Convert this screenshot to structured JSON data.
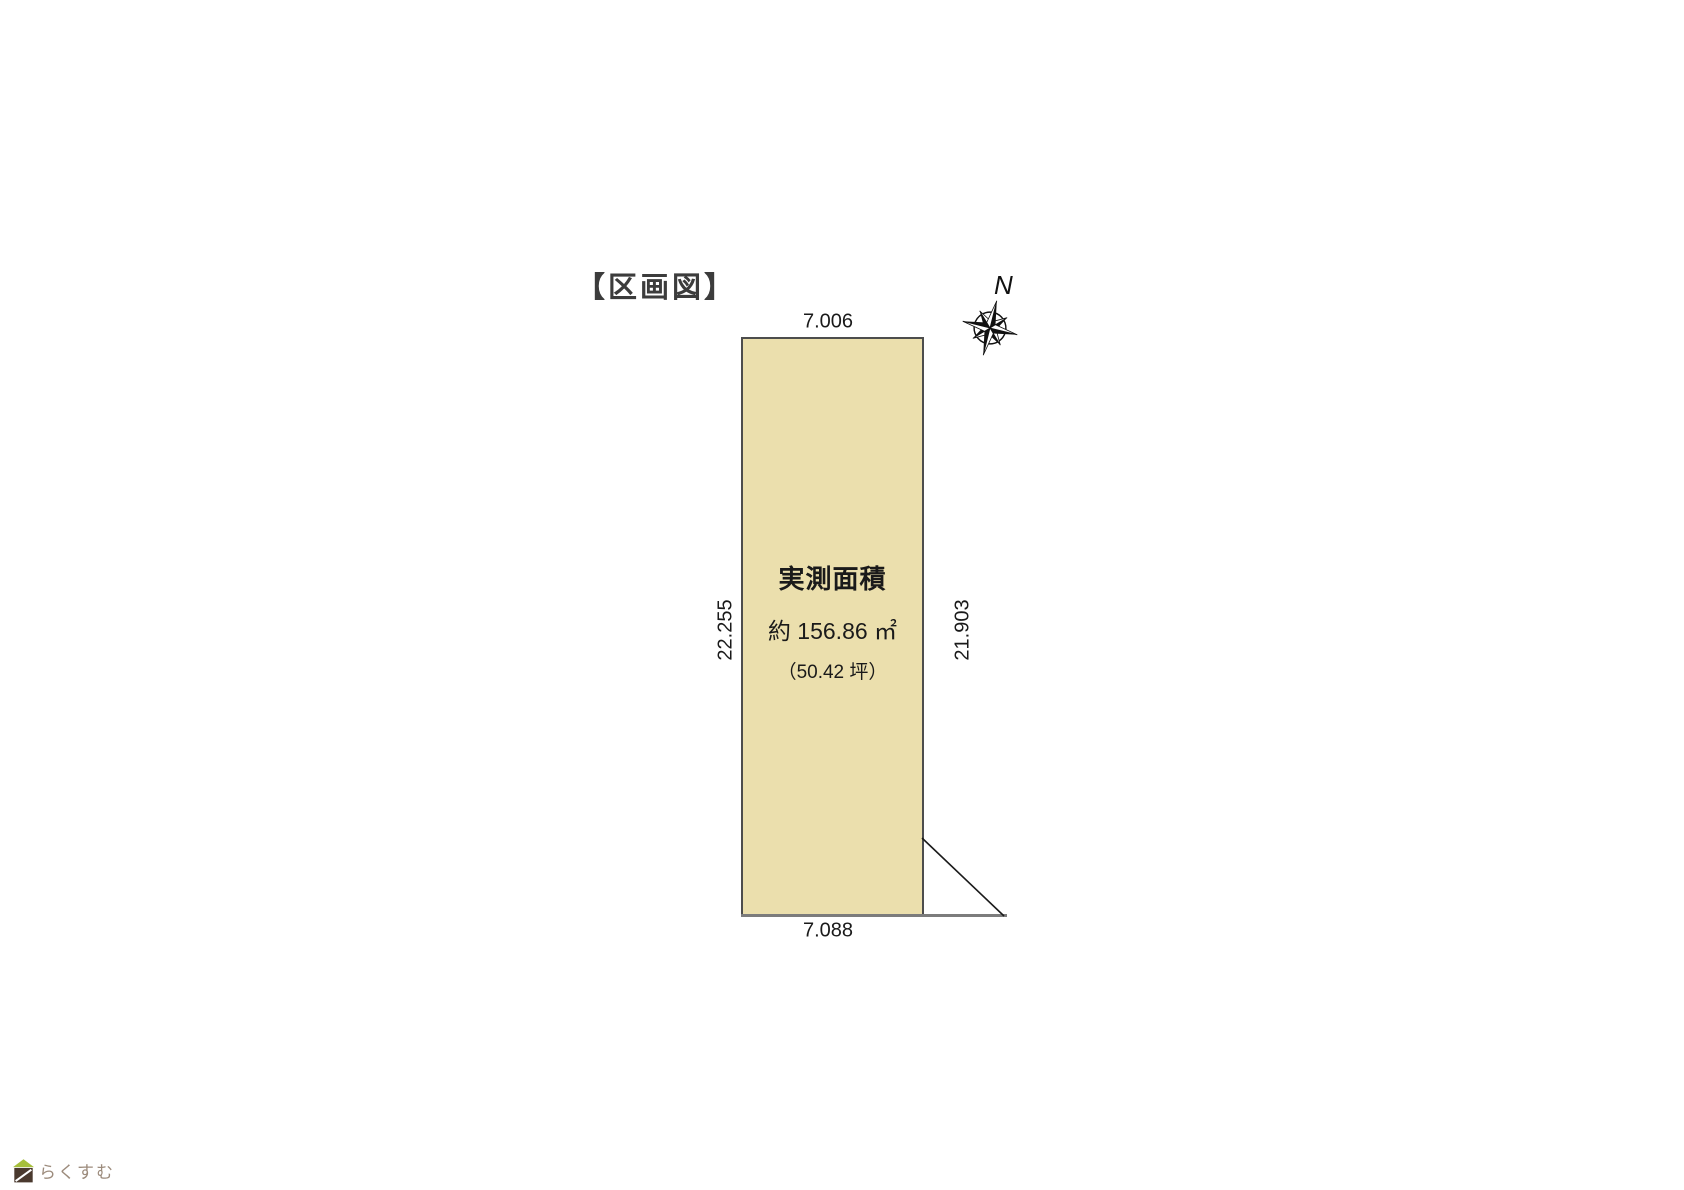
{
  "title": "【区画図】",
  "compass": {
    "north_label": "N",
    "icon": "compass-rose-icon"
  },
  "parcel": {
    "area_title": "実測面積",
    "area_m2": "約 156.86 ㎡",
    "area_tsubo": "（50.42 坪）",
    "dim_top": "7.006",
    "dim_bottom": "7.088",
    "dim_left": "22.255",
    "dim_right": "21.903",
    "fill_color": "#EBDFAD",
    "border_color": "#4D4D4D",
    "road_line_color": "#7C7C7C"
  },
  "footer": {
    "brand": "らくすむ",
    "brand_color": "#9C8B7C",
    "icon": "house-logo-icon",
    "roof_color": "#A6BF3B",
    "body_color": "#4A392E"
  }
}
